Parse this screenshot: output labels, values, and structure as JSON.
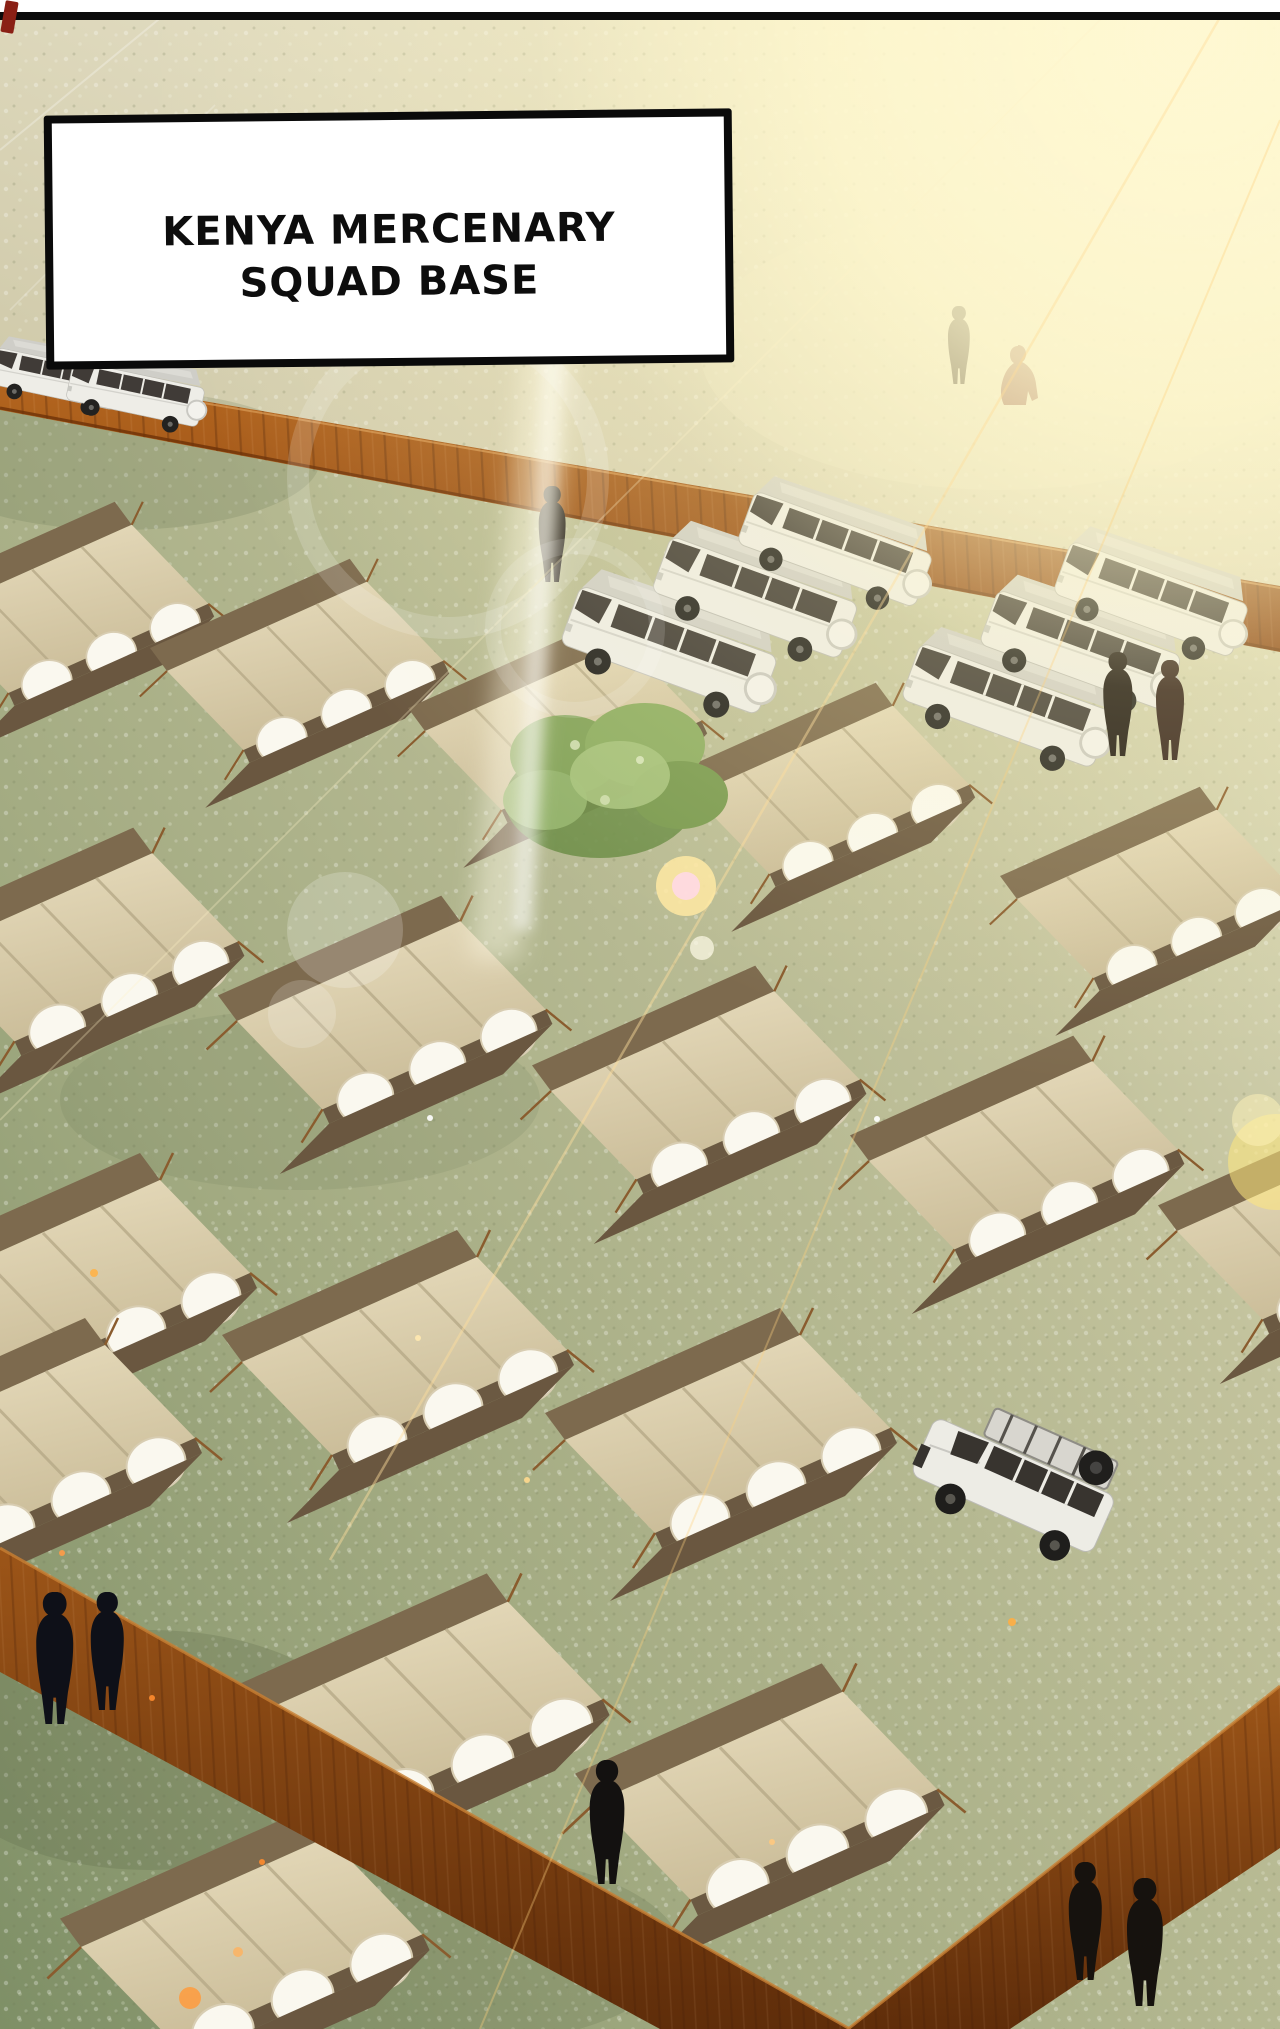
{
  "caption": {
    "line1": "KENYA MERCENARY",
    "line2": "SQUAD BASE"
  },
  "palette": {
    "grass_light": "#ece8cc",
    "grass_mid": "#b4b892",
    "grass_dark": "#7e8f66",
    "fence_rust": "#b5671f",
    "fence_shadow": "#6e3208",
    "tent_canvas": "#e3d7b4",
    "tent_floor": "#6a5740",
    "tent_wall_white": "#faf8ef",
    "vehicle_white": "#edece5",
    "silhouette_black": "#15100d",
    "sun_glow": "#fff9d8",
    "flare_orange": "#ff9b3d"
  },
  "scene": {
    "tents": [
      {
        "x": -85,
        "y": 495,
        "s": 0.85
      },
      {
        "x": 150,
        "y": 552,
        "s": 0.85
      },
      {
        "x": 408,
        "y": 612,
        "s": 0.85
      },
      {
        "x": 676,
        "y": 676,
        "s": 0.85
      },
      {
        "x": 1000,
        "y": 780,
        "s": 0.85
      },
      {
        "x": -90,
        "y": 820,
        "s": 0.95
      },
      {
        "x": 218,
        "y": 888,
        "s": 0.95
      },
      {
        "x": 532,
        "y": 958,
        "s": 0.95
      },
      {
        "x": 850,
        "y": 1028,
        "s": 0.95
      },
      {
        "x": 1158,
        "y": 1098,
        "s": 0.95
      },
      {
        "x": -95,
        "y": 1145,
        "s": 1.0
      },
      {
        "x": 222,
        "y": 1222,
        "s": 1.0
      },
      {
        "x": 545,
        "y": 1300,
        "s": 1.0
      },
      {
        "x": -150,
        "y": 1310,
        "s": 1.0
      },
      {
        "x": 240,
        "y": 1565,
        "s": 1.05
      },
      {
        "x": 575,
        "y": 1655,
        "s": 1.05
      },
      {
        "x": 60,
        "y": 1800,
        "s": 1.05
      }
    ],
    "vehicles": [
      {
        "type": "van",
        "x": 0,
        "y": 332,
        "r": 12,
        "s": 0.6
      },
      {
        "type": "van",
        "x": 76,
        "y": 344,
        "r": 12,
        "s": 0.64
      },
      {
        "type": "van",
        "x": 588,
        "y": 560,
        "r": 20,
        "s": 1.0
      },
      {
        "type": "van",
        "x": 678,
        "y": 512,
        "r": 20,
        "s": 0.95
      },
      {
        "type": "van",
        "x": 762,
        "y": 468,
        "r": 20,
        "s": 0.9
      },
      {
        "type": "van",
        "x": 928,
        "y": 618,
        "r": 20,
        "s": 0.97
      },
      {
        "type": "van",
        "x": 1005,
        "y": 566,
        "r": 20,
        "s": 0.93
      },
      {
        "type": "van",
        "x": 1078,
        "y": 518,
        "r": 20,
        "s": 0.9
      },
      {
        "type": "suv",
        "x": 948,
        "y": 1384,
        "r": 24,
        "s": 1.02
      }
    ],
    "people": [
      {
        "x": 556,
        "y": 486,
        "h": 96,
        "pose": "stand",
        "color": "#171210"
      },
      {
        "x": 962,
        "y": 306,
        "h": 78,
        "pose": "stand",
        "color": "#26190f"
      },
      {
        "x": 1016,
        "y": 345,
        "h": 60,
        "pose": "crouch",
        "color": "#7a3326"
      },
      {
        "x": 1122,
        "y": 652,
        "h": 104,
        "pose": "stand",
        "color": "#1b1410"
      },
      {
        "x": 1174,
        "y": 660,
        "h": 100,
        "pose": "stand",
        "color": "#32201a"
      },
      {
        "x": 60,
        "y": 1592,
        "h": 132,
        "pose": "stand",
        "color": "#0e1018"
      },
      {
        "x": 112,
        "y": 1592,
        "h": 118,
        "pose": "stand",
        "color": "#0e1018"
      },
      {
        "x": 612,
        "y": 1760,
        "h": 124,
        "pose": "stand",
        "color": "#131110"
      },
      {
        "x": 1090,
        "y": 1862,
        "h": 118,
        "pose": "stand",
        "color": "#16120e"
      },
      {
        "x": 1150,
        "y": 1878,
        "h": 128,
        "pose": "stand",
        "color": "#16120e"
      }
    ],
    "flare": {
      "rays": [
        {
          "x1": 1230,
          "y1": 0,
          "x2": 330,
          "y2": 1560,
          "w": 2.5,
          "o": 0.45,
          "c": "#ffdf9e"
        },
        {
          "x1": 1280,
          "y1": 120,
          "x2": 480,
          "y2": 2029,
          "w": 2.0,
          "o": 0.35,
          "c": "#ffd27f"
        },
        {
          "x1": 1120,
          "y1": 0,
          "x2": 0,
          "y2": 1120,
          "w": 1.8,
          "o": 0.3,
          "c": "#fff3c8"
        },
        {
          "x1": 0,
          "y1": 150,
          "x2": 170,
          "y2": 10,
          "w": 2.0,
          "o": 0.28,
          "c": "#ffffff"
        },
        {
          "x1": 10,
          "y1": 310,
          "x2": 215,
          "y2": 105,
          "w": 1.6,
          "o": 0.22,
          "c": "#ffffff"
        }
      ],
      "rings": [
        {
          "cx": 448,
          "cy": 478,
          "r": 150,
          "w": 22,
          "o": 0.16
        },
        {
          "cx": 575,
          "cy": 628,
          "r": 82,
          "w": 16,
          "o": 0.14
        }
      ],
      "orbs": [
        {
          "cx": 686,
          "cy": 886,
          "r": 30,
          "c": "#ffe9a3",
          "o": 0.85
        },
        {
          "cx": 686,
          "cy": 886,
          "r": 14,
          "c": "#ffd9e4",
          "o": 0.9
        },
        {
          "cx": 702,
          "cy": 948,
          "r": 12,
          "c": "#fffbe8",
          "o": 0.7
        },
        {
          "cx": 345,
          "cy": 930,
          "r": 58,
          "c": "#ffffff",
          "o": 0.2
        },
        {
          "cx": 302,
          "cy": 1014,
          "r": 34,
          "c": "#ffffff",
          "o": 0.18
        },
        {
          "cx": 1276,
          "cy": 1162,
          "r": 48,
          "c": "#ffe87d",
          "o": 0.55
        },
        {
          "cx": 1258,
          "cy": 1120,
          "r": 26,
          "c": "#fff3b9",
          "o": 0.5
        },
        {
          "cx": 190,
          "cy": 1998,
          "r": 11,
          "c": "#ff9b3d",
          "o": 0.85
        },
        {
          "cx": 238,
          "cy": 1952,
          "r": 5,
          "c": "#ffb25e",
          "o": 0.8
        }
      ],
      "sparks": [
        {
          "cx": 94,
          "cy": 1273,
          "r": 4,
          "c": "#ffb347"
        },
        {
          "cx": 62,
          "cy": 1553,
          "r": 3,
          "c": "#ff9b47"
        },
        {
          "cx": 418,
          "cy": 1338,
          "r": 3,
          "c": "#ffe9b0"
        },
        {
          "cx": 877,
          "cy": 1119,
          "r": 3,
          "c": "#ffffff"
        },
        {
          "cx": 1012,
          "cy": 1622,
          "r": 4,
          "c": "#ffae42"
        },
        {
          "cx": 152,
          "cy": 1698,
          "r": 3,
          "c": "#ff8c2e"
        },
        {
          "cx": 262,
          "cy": 1862,
          "r": 3,
          "c": "#ff8c2e"
        },
        {
          "cx": 772,
          "cy": 1842,
          "r": 3,
          "c": "#ffc97e"
        },
        {
          "cx": 430,
          "cy": 1118,
          "r": 3,
          "c": "#ffffff"
        },
        {
          "cx": 527,
          "cy": 1480,
          "r": 3,
          "c": "#ffd98e"
        }
      ]
    }
  }
}
